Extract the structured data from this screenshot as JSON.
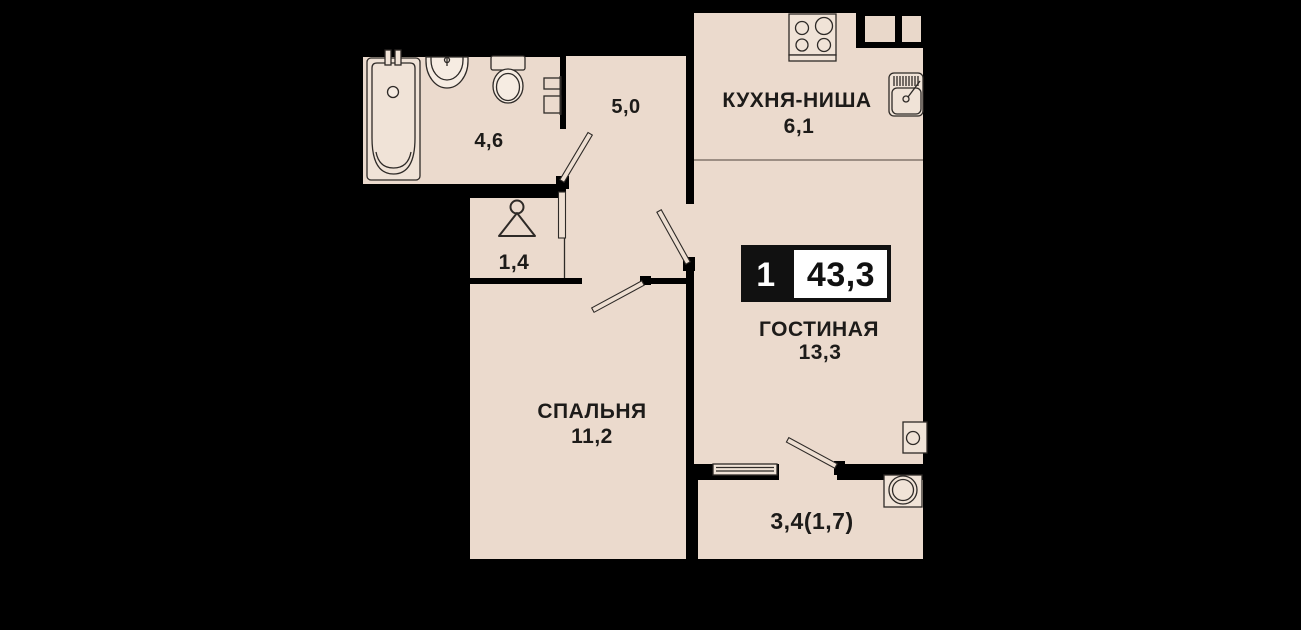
{
  "floorplan": {
    "badge": {
      "rooms_count": "1",
      "total_area": "43,3"
    },
    "rooms": {
      "bathroom": {
        "area": "4,6"
      },
      "hall": {
        "area": "5,0"
      },
      "kitchen": {
        "name": "КУХНЯ-НИША",
        "area": "6,1"
      },
      "living": {
        "name": "ГОСТИНАЯ",
        "area": "13,3"
      },
      "wardrobe": {
        "area": "1,4"
      },
      "bedroom": {
        "name": "СПАЛЬНЯ",
        "area": "11,2"
      },
      "balcony": {
        "area": "3,4(1,7)"
      }
    },
    "icons": [
      "bathtub-icon",
      "washbasin-icon",
      "toilet-icon",
      "towel-rail-icon",
      "stove-icon",
      "kitchen-sink-icon",
      "hanger-icon",
      "boiler-icon",
      "washing-machine-icon",
      "window-icon",
      "door-leaf-icon"
    ],
    "colors": {
      "background": "#000000",
      "floor": "#ebdacd",
      "fixture_fill": "#f0e3d7",
      "outline": "#2e2a27",
      "badge_bg": "#111111",
      "badge_fg": "#ffffff",
      "text": "#1d1b19"
    }
  }
}
